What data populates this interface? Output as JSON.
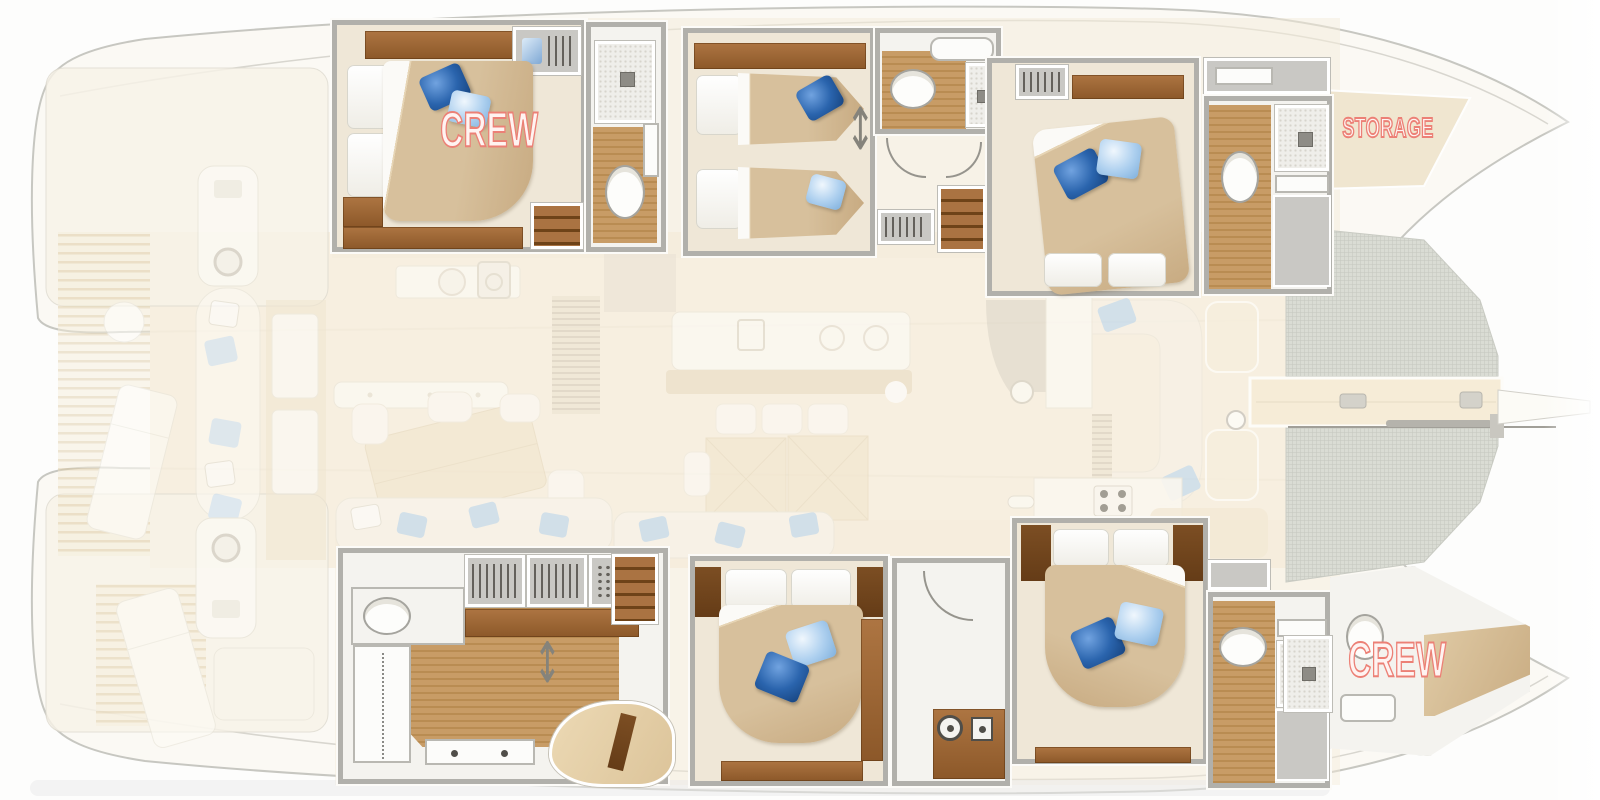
{
  "boat_plan": {
    "labels": {
      "crew_aft": "CREW",
      "storage": "STORAGE",
      "crew_bow": "CREW"
    },
    "label_color": "#ec8076",
    "palette": {
      "hull_outline": "#c7c7c1",
      "deck_beige": "#f6eedd",
      "cabin_floor": "#efe7d7",
      "teak_floor": "#c89c66",
      "wood_cabinet": "#9a6433",
      "wall_gray": "#b1b0ab",
      "bed_duvet_tan": "#d3ba95",
      "pillow_dark_blue": "#2a64ad",
      "pillow_light_blue": "#aed0ef",
      "trampoline_mesh": "#dadcd4"
    },
    "icons": {
      "toilet-icon": "white ellipse bowl",
      "shower-icon": "speckled square with drain",
      "bathtub-icon": "rounded white rectangle",
      "washer-icon": "circle-in-ring porthole",
      "dryer-icon": "square porthole",
      "stove-burner-icon": "circle",
      "oven-icon": "rounded square",
      "sink-icon": "circle basin",
      "helm-wheel-icon": "ring wheel",
      "wardrobe-hanger-icon": "vertical hanger strokes",
      "shoe-rack-icon": "dot grid",
      "stairs-icon": "tread stripes",
      "convertible-berth-arrow-icon": "↕",
      "mast-icon": "horizontal spar line",
      "trampoline-net": "fine grid mesh"
    }
  }
}
